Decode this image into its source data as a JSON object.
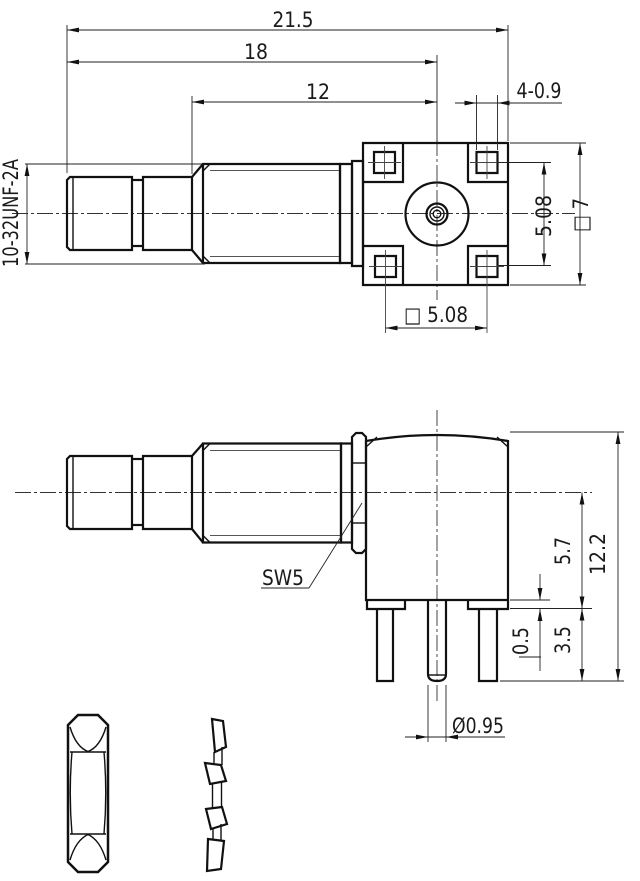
{
  "drawing": {
    "kind": "technical-drawing",
    "subject": "right-angle PCB coaxial connector with square mounting flange, lock nut and lock washer",
    "colors": {
      "line": "#111111",
      "thin_line": "#333333",
      "background": "#ffffff"
    }
  },
  "labels": {
    "total_length": "21.5",
    "length_to_center": "18",
    "thread_length": "12",
    "thread_spec": "10-32UNF-2A",
    "hole_callout": "4-0.9",
    "hole_pitch_vertical": "5.08",
    "flange_square": "□ 7",
    "hole_pitch_horizontal": "□ 5.08",
    "wrench_size": "SW5",
    "overall_height": "12.2",
    "axis_to_base": "5.7",
    "leg_length": "3.5",
    "standoff": "0.5",
    "pin_diameter": "Ø0.95"
  }
}
